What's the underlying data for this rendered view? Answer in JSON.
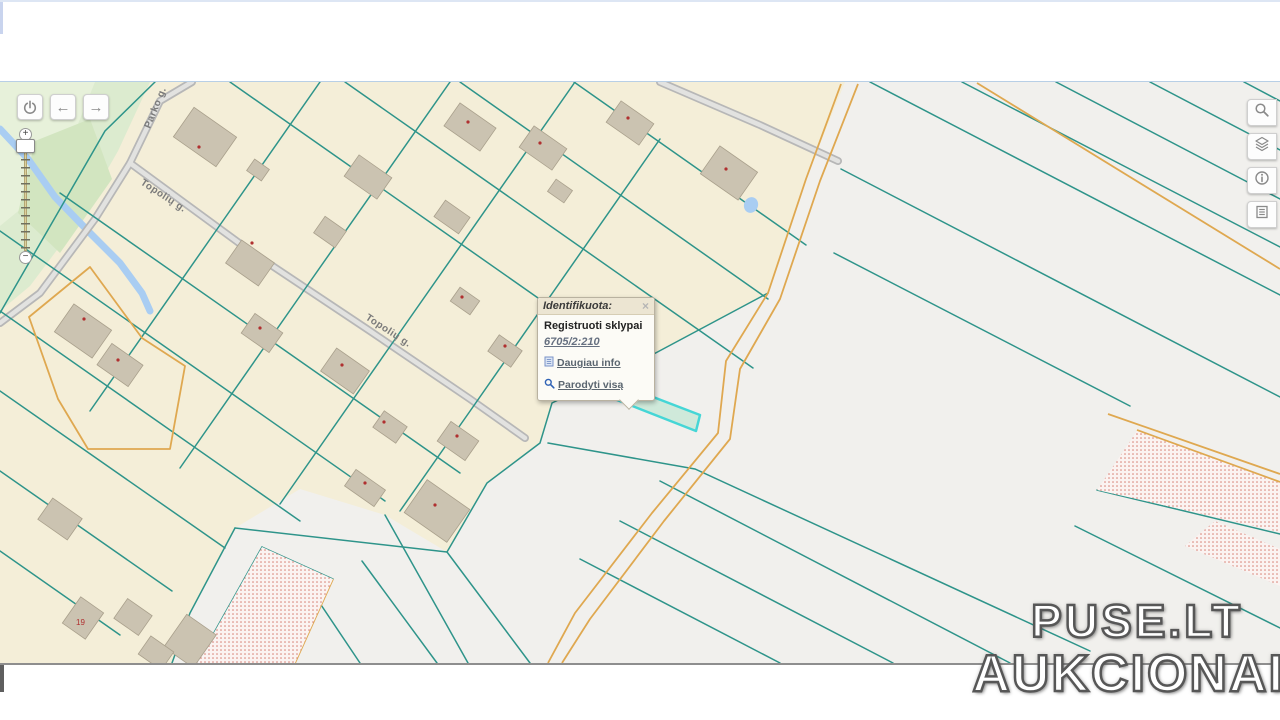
{
  "colors": {
    "parcel_boundary_teal": "#2e948a",
    "boundary_orange": "#dfa850",
    "residential_fill": "#f4eed8",
    "field_fill": "#f1f0ed",
    "park_fill": "#dcebcf",
    "road_fill": "#e2e2e0",
    "road_casing": "#b7b7b7",
    "building_fill": "#cbc3b1",
    "water_blue": "#a9cdf2",
    "highlight_stroke": "#45d6d6",
    "highlight_fill": "#cfe9da",
    "hatch_dot_red": "#d4766a",
    "street_label_gray": "#7a7a7a",
    "house_number_red": "#b03030"
  },
  "toolbar_left": {
    "buttons": [
      {
        "icon": "power-icon"
      },
      {
        "icon": "arrow-left-icon",
        "glyph": "←"
      },
      {
        "icon": "arrow-right-icon",
        "glyph": "→"
      }
    ]
  },
  "zoom_slider": {
    "zoom_in_label": "+",
    "zoom_out_label": "−"
  },
  "toolbar_right": {
    "buttons": [
      {
        "icon": "search-icon"
      },
      {
        "icon": "layers-icon"
      },
      {
        "icon": "info-icon"
      },
      {
        "icon": "legend-icon"
      }
    ]
  },
  "map": {
    "street_labels": [
      "Parko g.",
      "Topolių g.",
      "Topolių g."
    ],
    "house_number": "19"
  },
  "popup": {
    "title": "Identifikuota:",
    "close_label": "×",
    "layer_name": "Registruoti sklypai",
    "parcel_code": "6705/2:210",
    "links": [
      {
        "icon": "page-icon",
        "label": "Daugiau info"
      },
      {
        "icon": "magnifier-icon",
        "label": "Parodyti visą"
      }
    ]
  },
  "watermark": {
    "line1": "PUSE.LT",
    "line2": "AUKCIONAI"
  }
}
